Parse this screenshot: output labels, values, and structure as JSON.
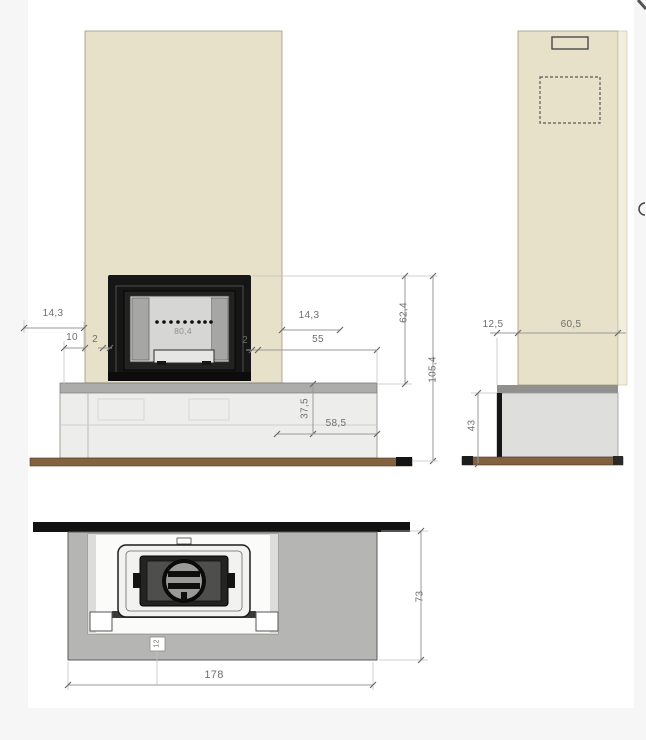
{
  "colors": {
    "page_bg": "#f6f6f6",
    "paper_bg": "#ffffff",
    "column_beige": "#e7e1c9",
    "column_edge_light": "#f2eedc",
    "bench_front": "#ededeb",
    "bench_side": "#dededc",
    "slab_gray": "#acacaa",
    "plan_gray": "#b5b5b3",
    "floor_brown": "#84613f",
    "frame_black": "#161616",
    "dim_gray": "#9a9a98",
    "dim_text": "#6e6e6c"
  },
  "views": {
    "front": {
      "dims": {
        "left_offset": "14,3",
        "plinth_side": "10",
        "gap_left": "2",
        "insert_width": "80,4",
        "right_offset": "14,3",
        "gap_right": "2",
        "bench_right_width": "55",
        "insert_height_above_bench": "62,4",
        "total_height": "105,4",
        "bench_tier_height": "37,5",
        "bench_right_depth": "58,5"
      }
    },
    "side": {
      "dims": {
        "bench_overhang": "12,5",
        "column_depth": "60,5",
        "bench_height": "43"
      }
    },
    "plan": {
      "dims": {
        "total_width": "178",
        "total_depth": "73",
        "hearth_detail": "12"
      }
    }
  }
}
